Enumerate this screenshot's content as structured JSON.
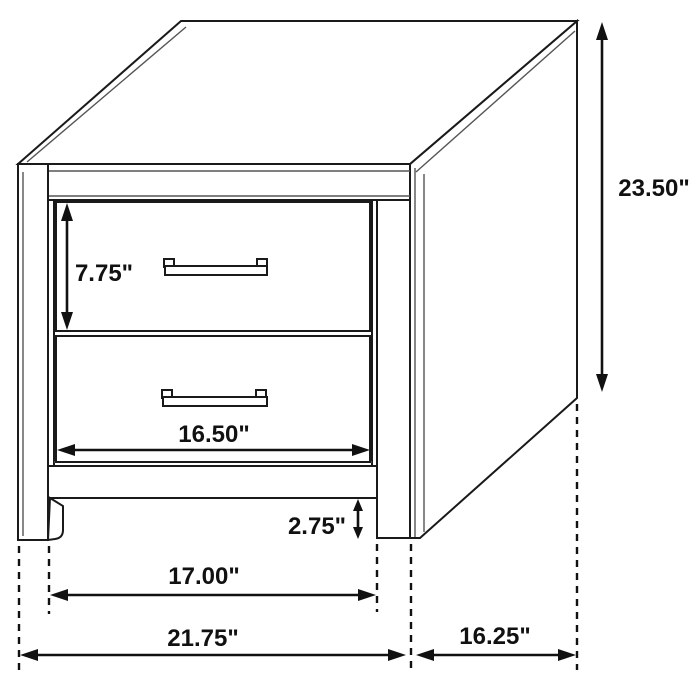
{
  "page": {
    "background_color": "#ffffff",
    "line_color": "#1a1a1a"
  },
  "diagram": {
    "subject": "two-drawer-nightstand-dimension-drawing",
    "drawer_count": 2,
    "labels": {
      "overall_height": "23.50\"",
      "top_drawer_height": "7.75\"",
      "drawer_width": "16.50\"",
      "base_clearance": "2.75\"",
      "leg_inner_span": "17.00\"",
      "overall_width": "21.75\"",
      "overall_depth": "16.25\""
    }
  }
}
